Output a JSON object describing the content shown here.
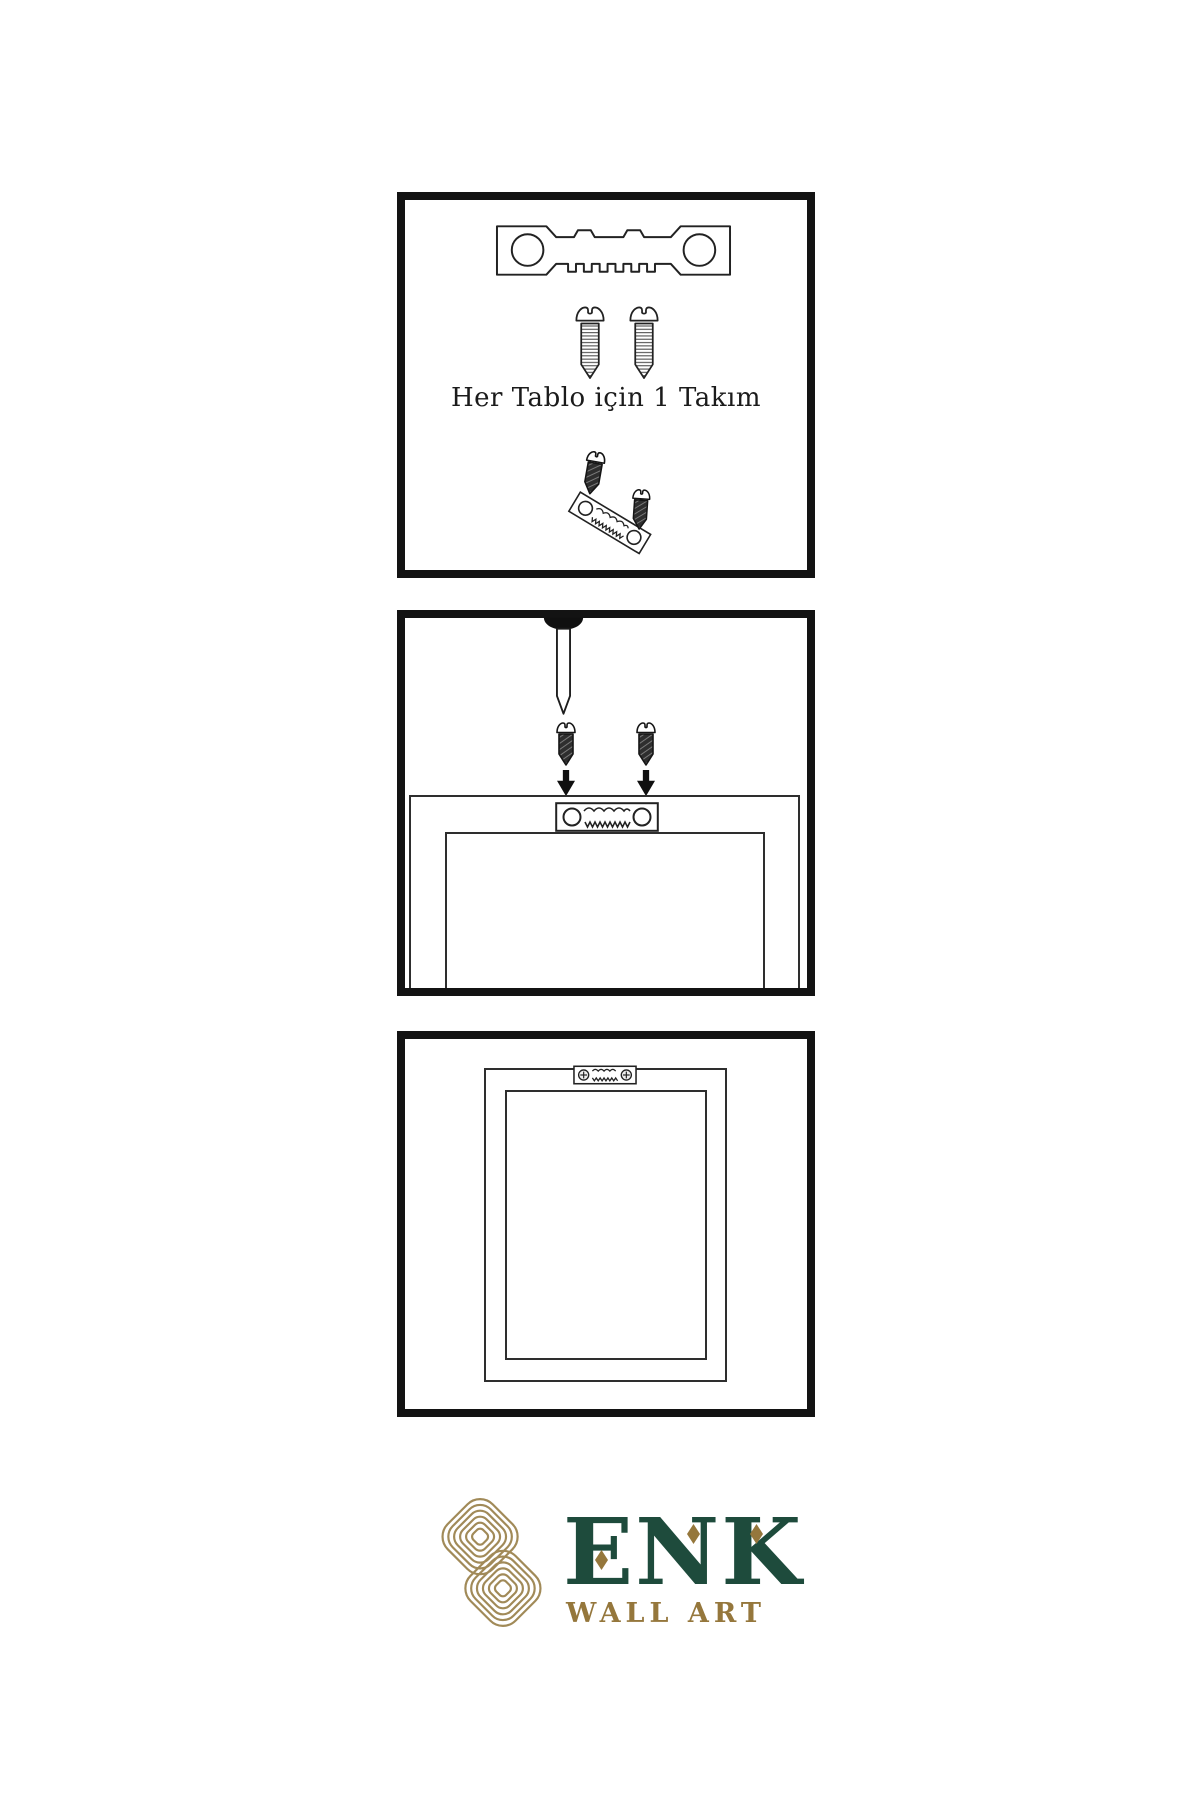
{
  "page": {
    "background": "#ffffff",
    "width": 1200,
    "height": 1800
  },
  "colors": {
    "line": "#222222",
    "panel_border": "#131313",
    "brand_green": "#1e4b3c",
    "brand_gold": "#95773c",
    "knot_gold": "#a18a58"
  },
  "panels": [
    {
      "name": "hardware-kit",
      "caption": "Her Tablo için 1 Takım",
      "icons": [
        "sawtooth-hanger-icon",
        "screw-icon",
        "screw-icon",
        "dark-screw-icon",
        "tilted-sawtooth-hanger-icon",
        "dark-screw-icon"
      ]
    },
    {
      "name": "attach-hanger-to-frame",
      "icons": [
        "wall-nail-icon",
        "dark-screw-icon",
        "dark-screw-icon",
        "down-arrow-icon",
        "down-arrow-icon",
        "sawtooth-hanger-icon",
        "frame-back"
      ]
    },
    {
      "name": "frame-hung-on-wall",
      "icons": [
        "mounted-sawtooth-hanger-icon",
        "frame-back"
      ]
    }
  ],
  "logo": {
    "brand": "ENK",
    "subtitle": "WALL ART",
    "mark": "interlocked-knot-icon",
    "accents": [
      "diamond-accent-icon",
      "diamond-accent-icon",
      "diamond-accent-icon"
    ]
  }
}
